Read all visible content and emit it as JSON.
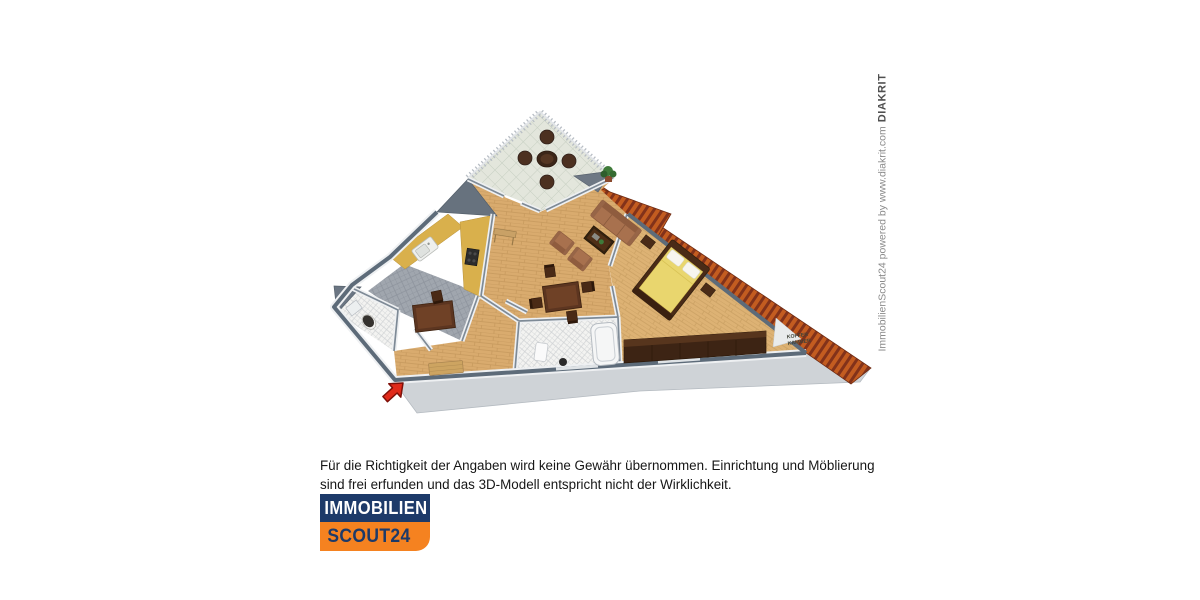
{
  "canvas": {
    "width": 1200,
    "height": 600,
    "background": "#ffffff"
  },
  "floorplan": {
    "koffer_label": {
      "line1": "KOFFER",
      "line2": "KAMMER"
    },
    "colors": {
      "wall_cap": "#5d6b79",
      "wall_face": "#eef0f2",
      "living_wood": "#d9ab6e",
      "bedroom_wood": "#ddb274",
      "kitchen_tile": "#a0a6ae",
      "bath_tile": "#f3f3f1",
      "balcony_tile": "#e3e6dc",
      "roof_orange": "#c35c20",
      "roof_dark": "#82321a",
      "platform_gray": "#cfd3d7",
      "counter_yellow": "#d9b04c",
      "bed_cover_yellow": "#e9d66e",
      "sofa_brown": "#a8714e",
      "dark_wood": "#4a2b17",
      "arrow_red": "#e02a1a"
    }
  },
  "disclaimer": {
    "lines": [
      "Für die Richtigkeit der Angaben wird keine Gewähr übernommen. Einrichtung und Möblierung",
      "sind frei erfunden und das 3D-Modell entspricht nicht der Wirklichkeit."
    ]
  },
  "logo": {
    "line1": "IMMOBILIEN",
    "line2": "SCOUT24",
    "navy": "#1d3a69",
    "orange": "#f58220"
  },
  "watermark": {
    "text": "ImmobilienScout24 powered by www.diakrit.com",
    "brand": "DIAKRIT"
  }
}
